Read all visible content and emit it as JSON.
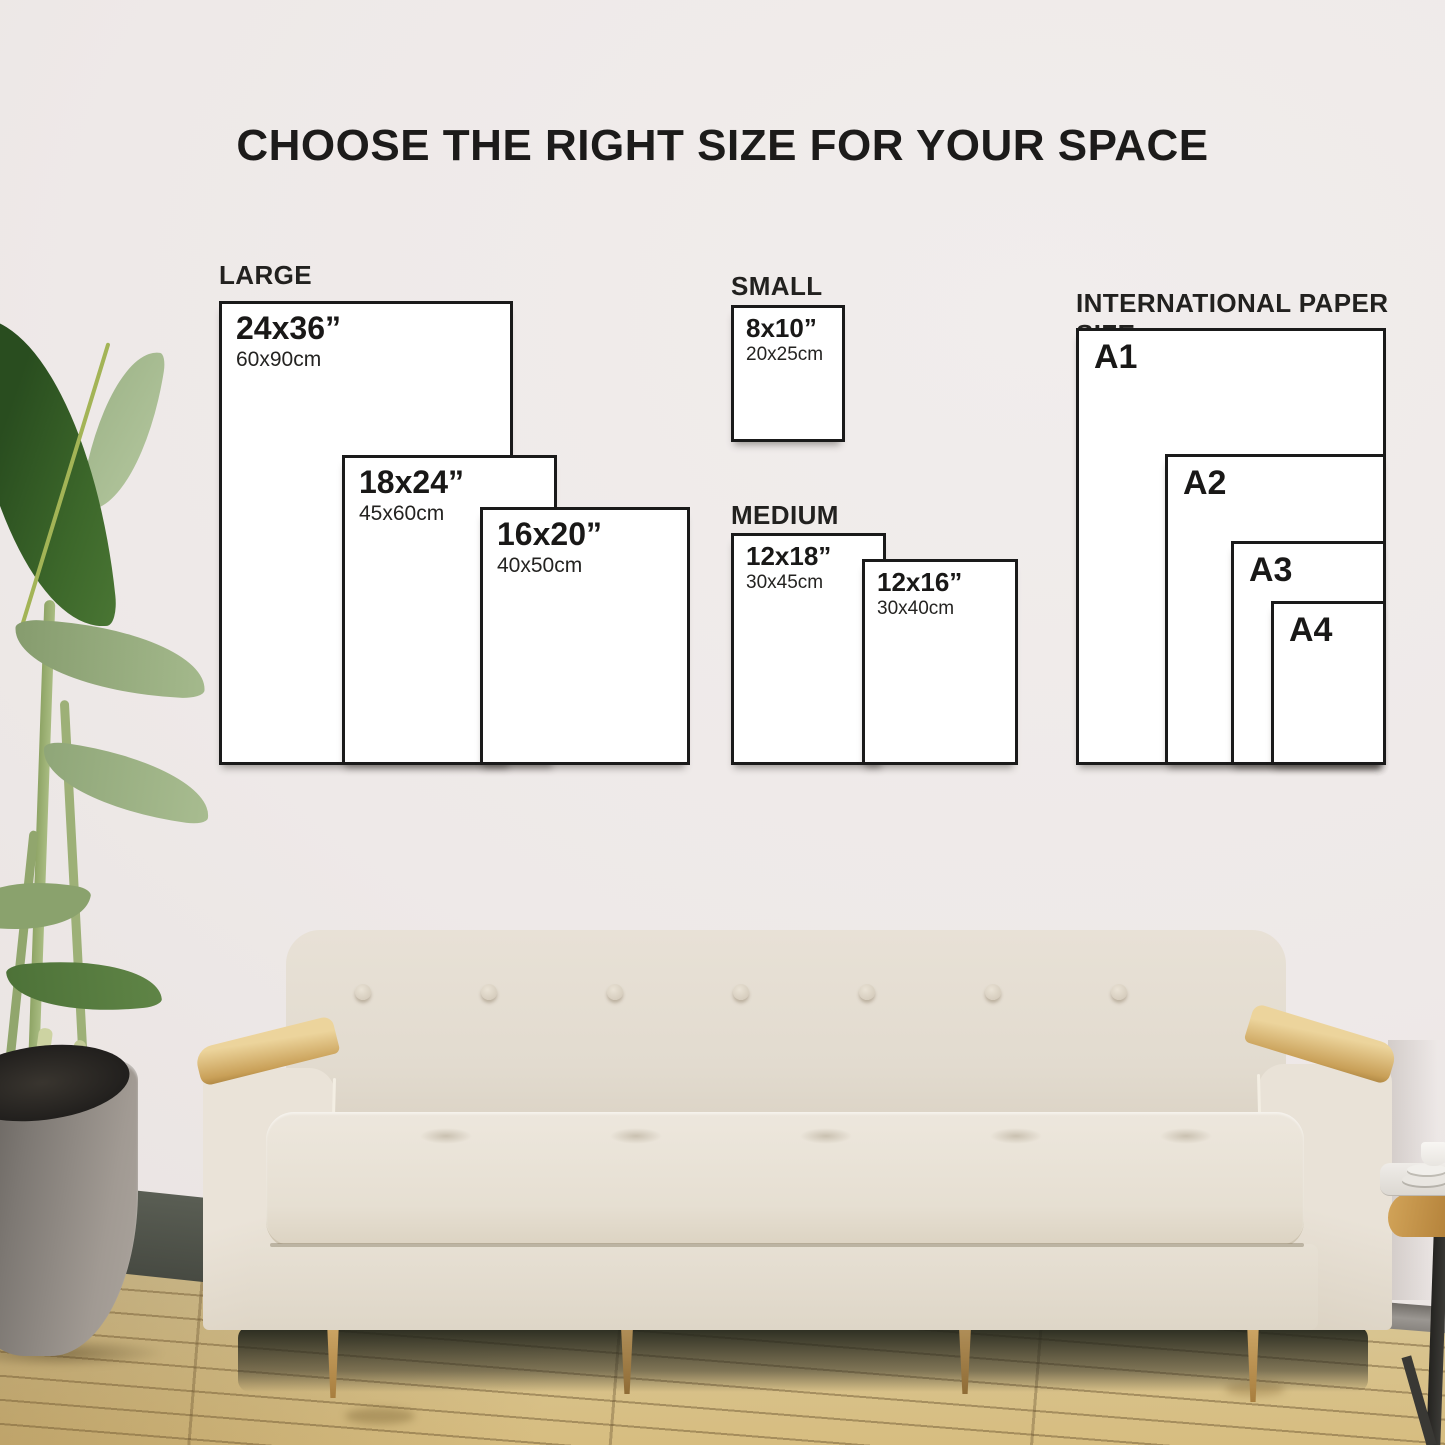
{
  "title": "CHOOSE THE RIGHT SIZE FOR YOUR SPACE",
  "groups": {
    "large": {
      "label": "LARGE",
      "boxes": [
        {
          "size": "24x36”",
          "metric": "60x90cm"
        },
        {
          "size": "18x24”",
          "metric": "45x60cm"
        },
        {
          "size": "16x20”",
          "metric": "40x50cm"
        }
      ]
    },
    "small": {
      "label": "SMALL",
      "boxes": [
        {
          "size": "8x10”",
          "metric": "20x25cm"
        }
      ]
    },
    "medium": {
      "label": "MEDIUM",
      "boxes": [
        {
          "size": "12x18”",
          "metric": "30x45cm"
        },
        {
          "size": "12x16”",
          "metric": "30x40cm"
        }
      ]
    },
    "international": {
      "label": "INTERNATIONAL PAPER SIZE",
      "boxes": [
        {
          "size": "A1"
        },
        {
          "size": "A2"
        },
        {
          "size": "A3"
        },
        {
          "size": "A4"
        }
      ]
    }
  },
  "colors": {
    "wall": "#eee9e8",
    "box_fill": "#ffffff",
    "box_border": "#1a1a1a",
    "text": "#1b1a19",
    "sofa_fabric": "#e6dfd4",
    "wood_accent": "#c9a058",
    "floor": "#d7c28a",
    "leaf_green": "#3c672a"
  }
}
